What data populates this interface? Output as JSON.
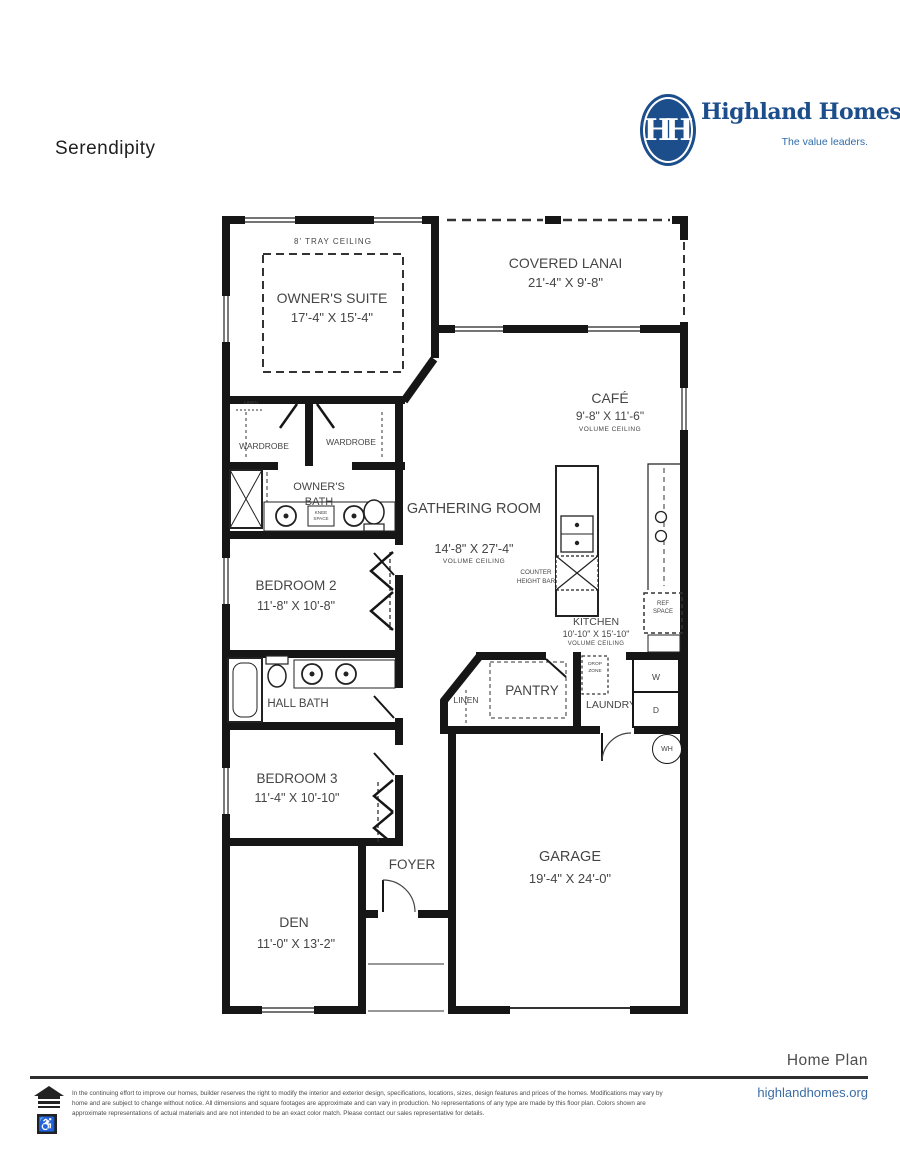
{
  "title": "Serendipity",
  "logo": {
    "monogram": "HH",
    "name": "Highland Homes",
    "tagline": "The value leaders.",
    "brand_color": "#1d4e8c"
  },
  "rooms": {
    "owners_suite": {
      "name": "OWNER'S SUITE",
      "dims": "17'-4\" X 15'-4\"",
      "note": "8' TRAY CEILING"
    },
    "covered_lanai": {
      "name": "COVERED LANAI",
      "dims": "21'-4\" X 9'-8\""
    },
    "cafe": {
      "name": "CAFÉ",
      "dims": "9'-8\" X 11'-6\"",
      "note": "VOLUME CEILING"
    },
    "gathering_room": {
      "name": "GATHERING ROOM",
      "dims": "14'-8\" X 27'-4\"",
      "note": "VOLUME CEILING"
    },
    "kitchen": {
      "name": "KITCHEN",
      "dims": "10'-10\" X 15'-10\"",
      "note": "VOLUME CEILING"
    },
    "bedroom_2": {
      "name": "BEDROOM 2",
      "dims": "11'-8\" X 10'-8\""
    },
    "bedroom_3": {
      "name": "BEDROOM 3",
      "dims": "11'-4\" X 10'-10\""
    },
    "den": {
      "name": "DEN",
      "dims": "11'-0\" X 13'-2\""
    },
    "garage": {
      "name": "GARAGE",
      "dims": "19'-4\" X 24'-0\""
    },
    "owners_bath": {
      "name": "OWNER'S BATH"
    },
    "hall_bath": {
      "name": "HALL BATH"
    },
    "wardrobe_1": {
      "name": "WARDROBE"
    },
    "wardrobe_2": {
      "name": "WARDROBE"
    },
    "pantry": {
      "name": "PANTRY"
    },
    "laundry": {
      "name": "LAUNDRY"
    },
    "foyer": {
      "name": "FOYER"
    },
    "linen_hall": {
      "name": "LINEN"
    },
    "linen_small": {
      "name": "LINEN"
    },
    "counter_height_bar": {
      "name": "COUNTER HEIGHT BAR"
    },
    "ref_space": {
      "name": "REF SPACE"
    },
    "drop_zone": {
      "name": "DROP ZONE"
    },
    "knee_space": {
      "name": "KNEE SPACE"
    }
  },
  "appliances": {
    "washer": "W",
    "dryer": "D",
    "water_heater": "WH"
  },
  "footer": {
    "label": "Home Plan",
    "website": "highlandhomes.org",
    "disclaimer": "In the continuing effort to improve our homes, builder reserves the right to modify the interior and exterior design, specifications, locations, sizes, design features and prices of the homes. Modifications may vary by home and are subject to change without notice. All dimensions and square footages are approximate and can vary in production. No representations of any type are made by this floor plan. Colors shown are approximate representations of actual materials and are not intended to be an exact color match. Please contact our sales representative for details."
  },
  "icons": {
    "wheelchair": "♿"
  }
}
